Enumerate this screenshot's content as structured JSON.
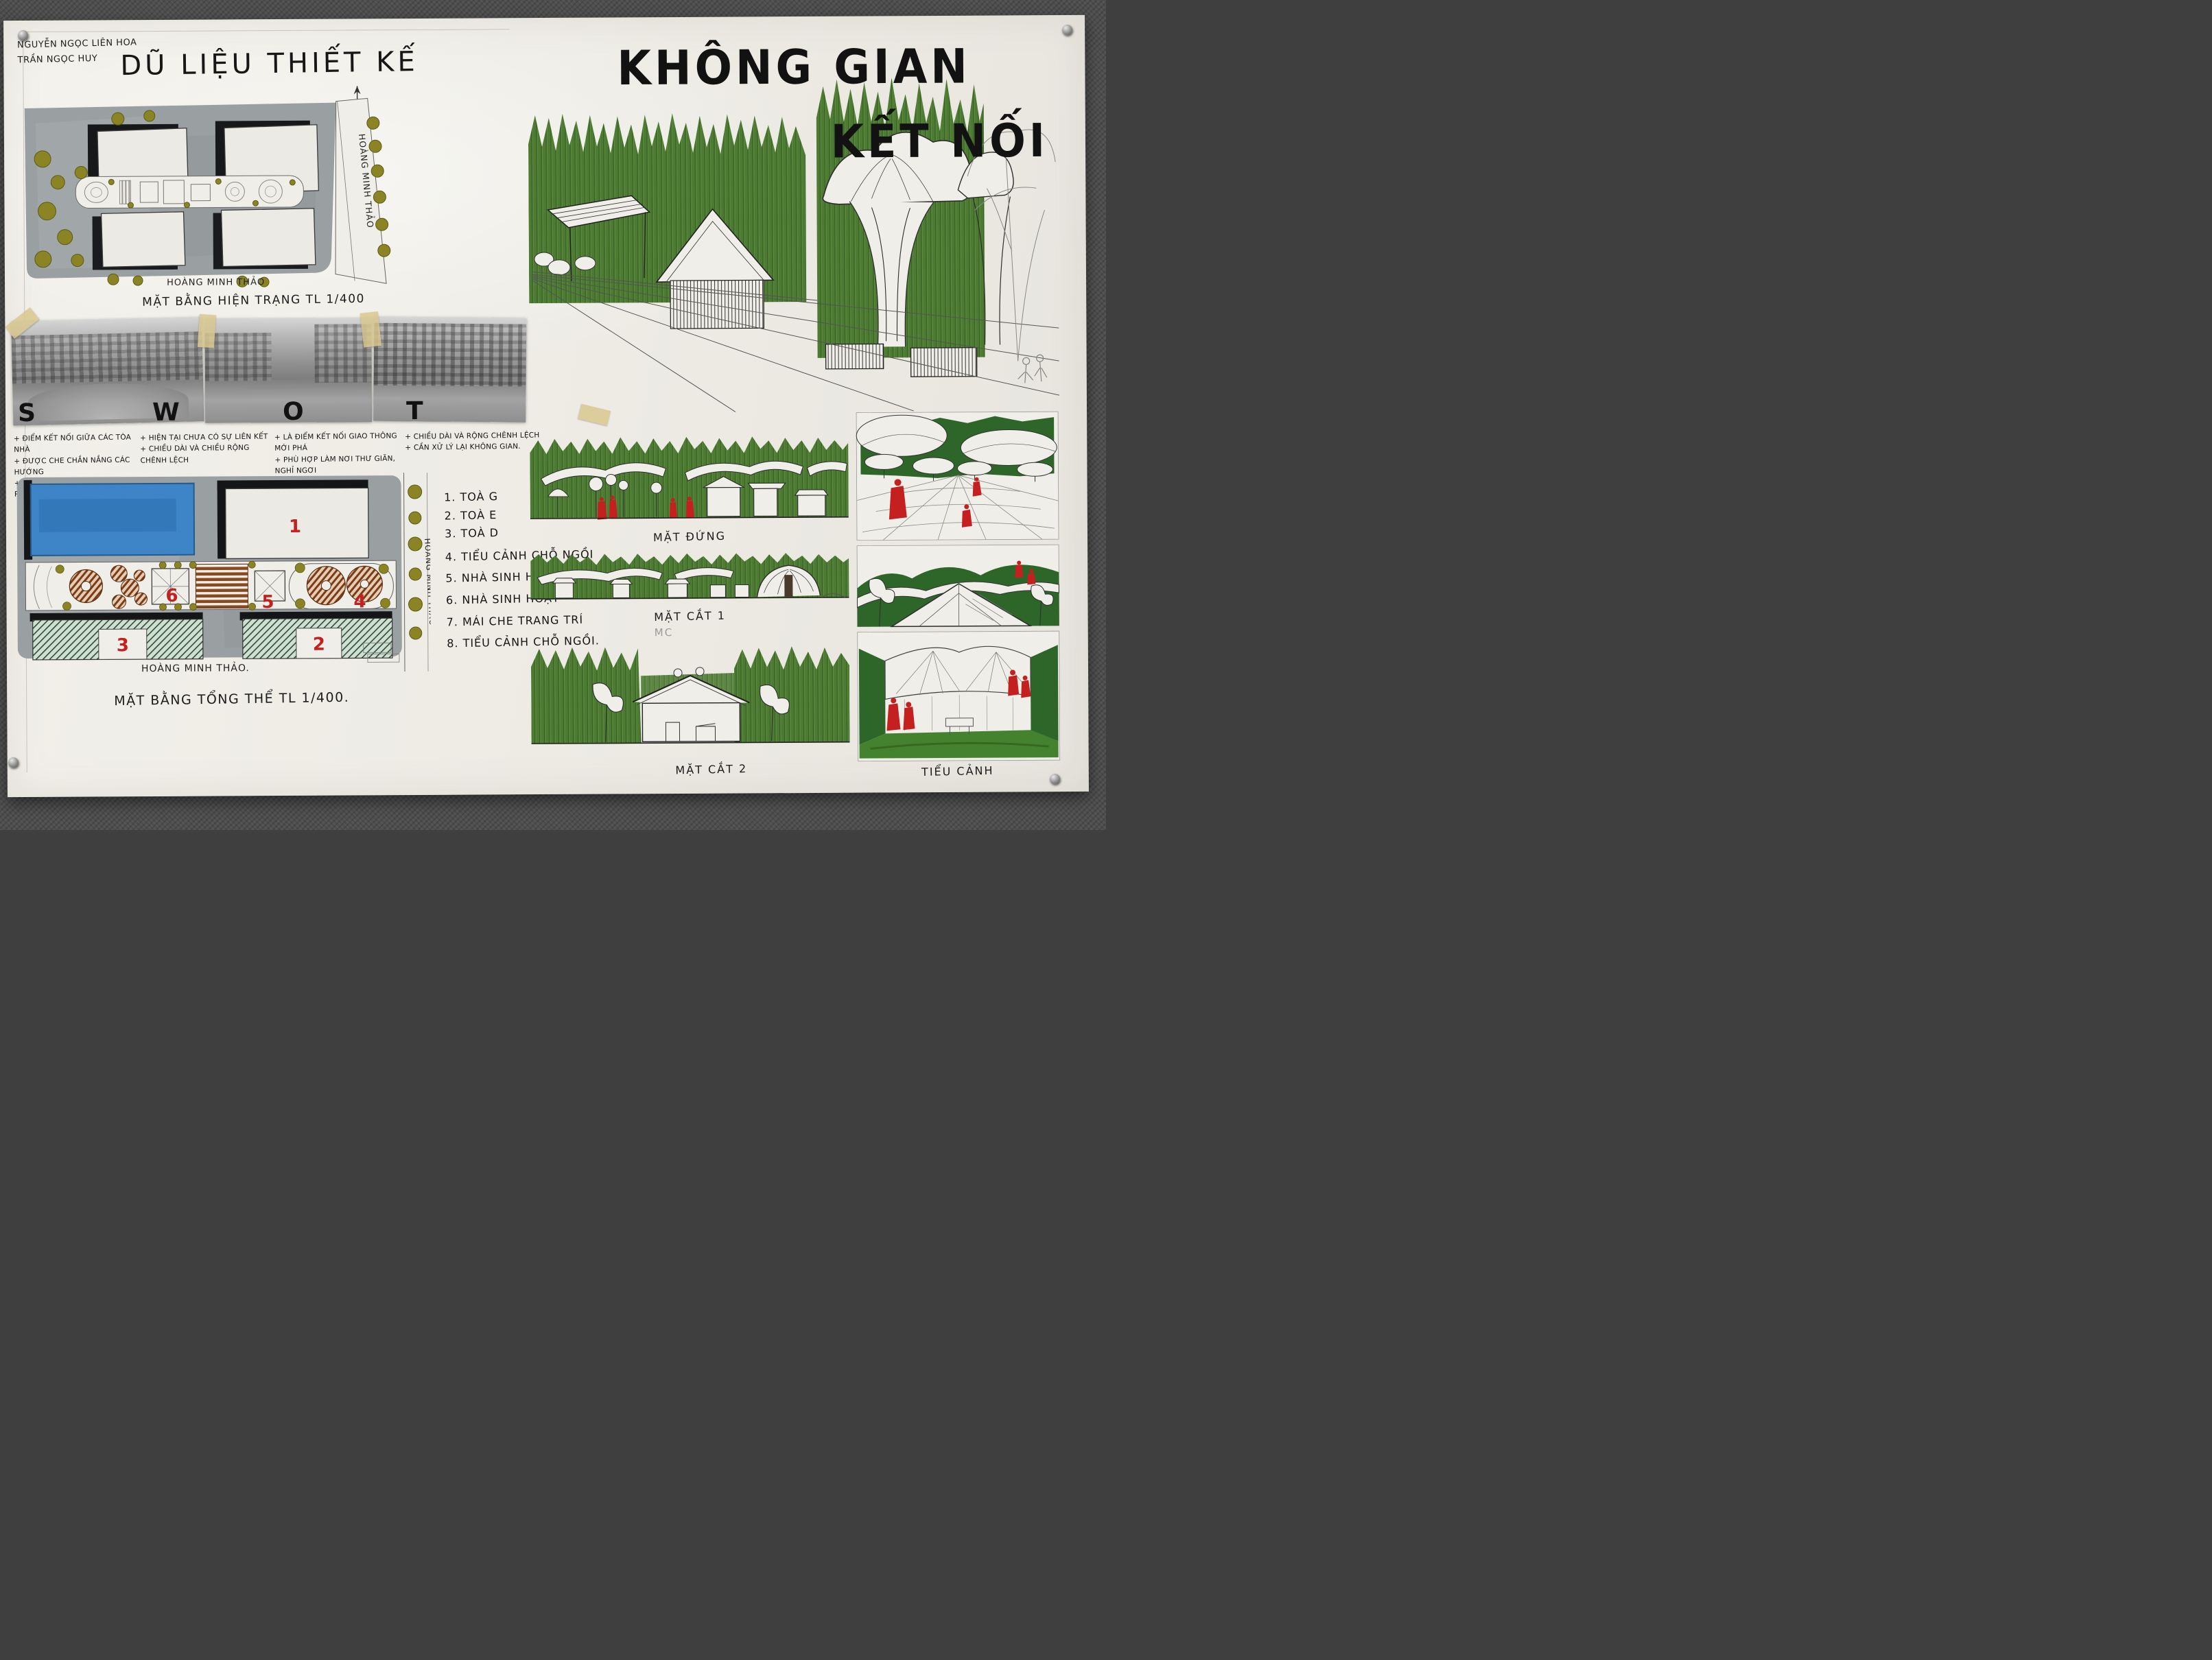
{
  "poster": {
    "authors": [
      "NGUYỄN NGỌC LIÊN HOA",
      "TRẦN NGỌC HUY"
    ],
    "design_data_title": "DŨ LIỆU THIẾT KẾ",
    "main_title": {
      "line1": "KHÔNG GIAN",
      "line2": "KẾT NỐI"
    }
  },
  "site_plan": {
    "street_right": "HOÀNG MINH THẢO",
    "street_bottom": "HOÀNG MINH THẢO",
    "caption": "MẶT BẰNG HIỆN TRẠNG TL 1/400"
  },
  "swot": {
    "s": {
      "letter": "S",
      "items": [
        "+ ĐIỂM KẾT NỐI GIỮA CÁC TÒA NHÀ",
        "+ ĐƯỢC CHE CHẮN NẮNG CÁC HƯỚNG",
        "+ KHÔNG GIAN XUNG QUANH RỘNG RÃI"
      ]
    },
    "w": {
      "letter": "W",
      "items": [
        "+ HIỆN TẠI CHƯA CÓ SỰ LIÊN KẾT",
        "+ CHIỀU DÀI VÀ CHIỀU RỘNG CHÊNH LỆCH"
      ]
    },
    "o": {
      "letter": "O",
      "items": [
        "+ LÀ ĐIỂM KẾT NỐI GIAO THÔNG MỚI PHÁ",
        "+ PHÙ HỢP LÀM NƠI THƯ GIÃN, NGHỈ NGƠI",
        "+ DI CHUYỂN THUẬN TIỆN"
      ]
    },
    "t": {
      "letter": "T",
      "items": [
        "+ CHIỀU DÀI VÀ RỘNG CHÊNH LỆCH",
        "+ CẦN XỬ LÝ LẠI KHÔNG GIAN."
      ]
    }
  },
  "master_plan": {
    "street_right": "HOÀNG MINH THẢO",
    "street_bottom": "HOÀNG MINH THẢO.",
    "caption": "MẶT BẰNG TỔNG THỂ TL 1/400.",
    "numbers": [
      "1",
      "2",
      "3",
      "4",
      "5",
      "6"
    ]
  },
  "legend": {
    "items": [
      "1. TOÀ G",
      "2. TOÀ E",
      "3. TOÀ D",
      "4. TIỂU CẢNH CHỖ NGỒI",
      "5. NHÀ SINH HOẠT",
      "6. NHÀ SINH HOẠT",
      "7. MÁI CHE TRANG TRÍ",
      "8. TIỂU CẢNH CHỖ NGỒI."
    ]
  },
  "sections": {
    "elevation": "MẶT ĐỨNG",
    "section1": "MẶT CẮT 1",
    "section1_note": "MC",
    "section2": "MẶT CẮT 2",
    "vignette": "TIỂU CẢNH"
  },
  "colors": {
    "marker_green": "#4e7b33",
    "deep_green": "#2e662a",
    "olive": "#8a8425",
    "pool_blue": "#3e85c7",
    "accent_red": "#c42020",
    "paper": "#f0eee8",
    "wall": "#4e4e4e"
  }
}
